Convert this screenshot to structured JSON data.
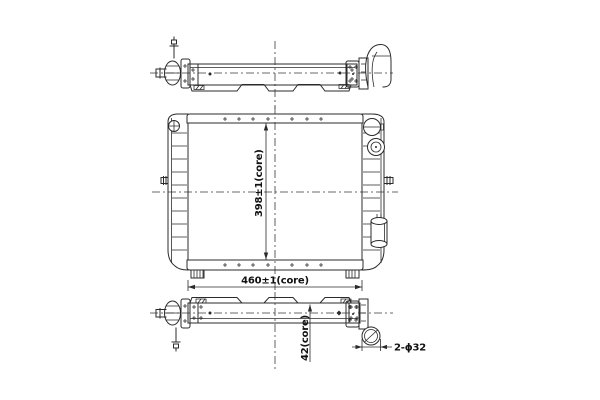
{
  "drawing": {
    "background_color": "#ffffff",
    "line_color": "#2b2b2b",
    "dimensions": {
      "core_height": "398±1(core)",
      "core_width": "460±1(core)",
      "core_depth": "42(core)",
      "pipe_note": "2-ϕ32"
    }
  }
}
